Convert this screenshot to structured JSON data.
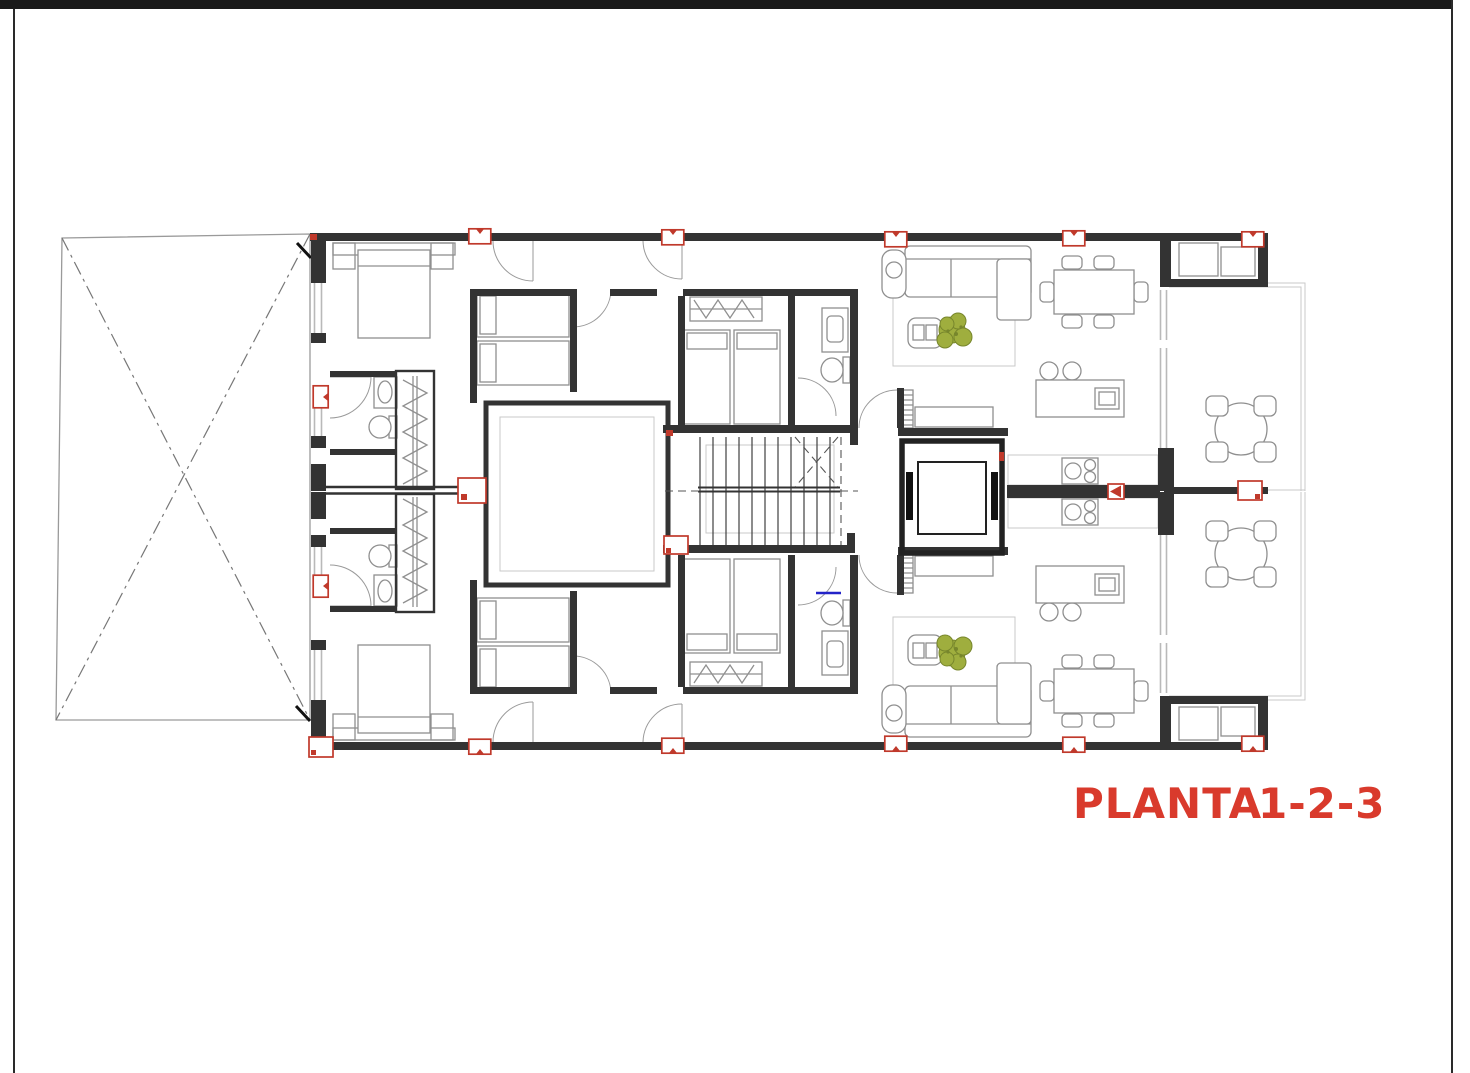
{
  "document": {
    "type": "architectural-floor-plan",
    "sheet": "residential building storey plan with two mirrored apartments, central patio, staircase and elevator"
  },
  "title": {
    "left": "PLANTA",
    "right": "1-2-3",
    "full": "PLANTA 1-2-3"
  },
  "colors": {
    "title_red": "#d93a2c",
    "column_marker_red": "#c0392b",
    "wall_dark": "#333333",
    "furniture_gray": "#8f8f8f",
    "window_gray": "#b9b9b9",
    "light_outline": "#c9c9c9",
    "plant_green": "#9fae3e",
    "plant_green_dark": "#77862c",
    "detail_blue": "#2323c8",
    "page_border_black": "#1a1a1a",
    "paper_white": "#ffffff"
  },
  "plan": {
    "elements": [
      "site-boundary-crossed-out",
      "building-shell",
      "central-patio",
      "staircase",
      "elevator-shaft",
      "double-bedroom",
      "twin-bedroom-a",
      "twin-bedroom-b",
      "bathroom-a",
      "bathroom-b",
      "wardrobe-with-hangers",
      "living-room-sofa",
      "armchair",
      "coffee-table",
      "potted-plant",
      "sideboard",
      "dining-table-six-chairs",
      "kitchen-island-with-stools",
      "kitchen-counter-cooktop",
      "terrace-round-table-four-chairs",
      "storage-niche",
      "structural-column-markers"
    ]
  }
}
